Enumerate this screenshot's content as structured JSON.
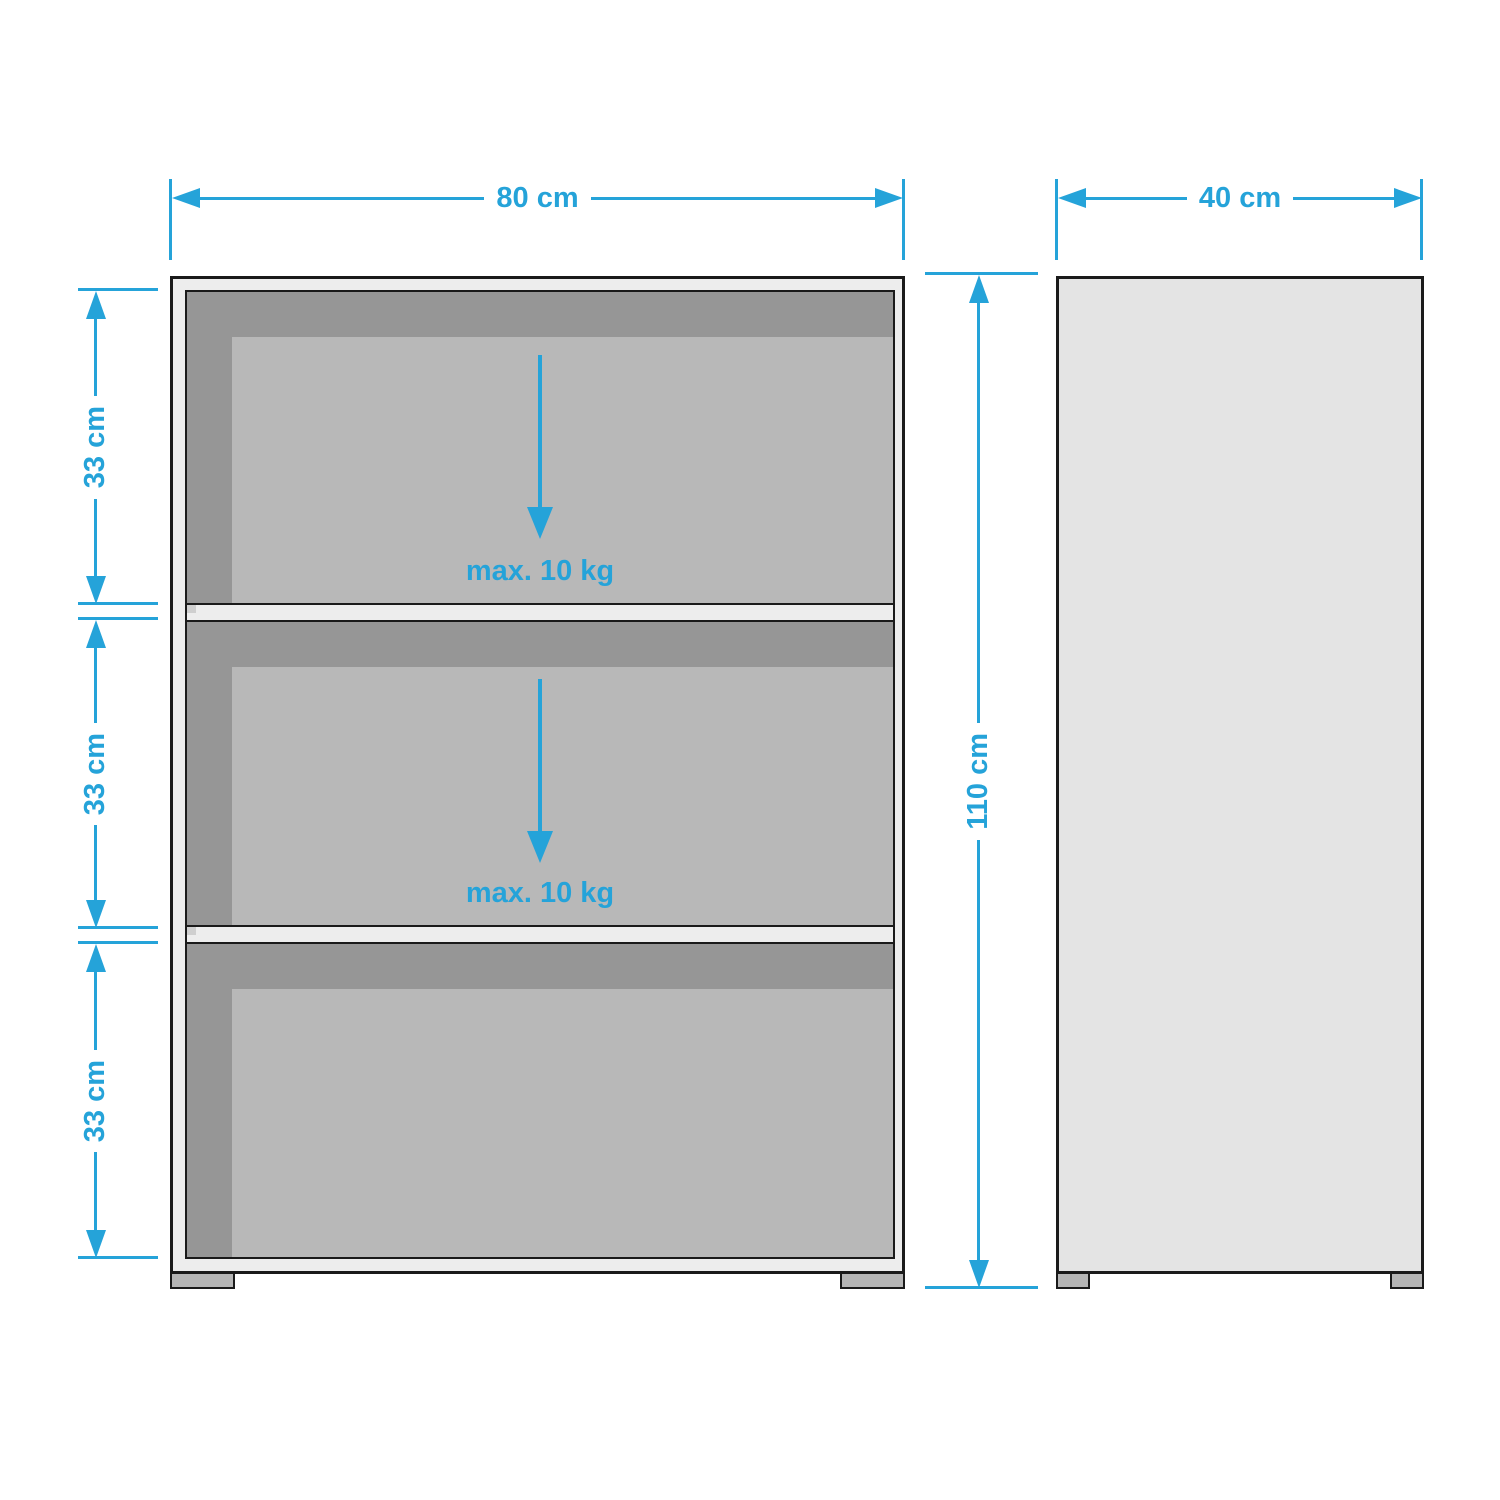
{
  "diagram": {
    "kind": "furniture-dimension-diagram",
    "views": {
      "front": "front-view",
      "side": "side-view"
    },
    "shelf_count": 3
  },
  "dimensions": {
    "width_label": "80 cm",
    "depth_label": "40 cm",
    "height_label": "110 cm",
    "compartment_height_labels": [
      "33 cm",
      "33 cm",
      "33 cm"
    ],
    "shelf_load_labels": [
      "max. 10 kg",
      "max. 10 kg"
    ]
  },
  "colors": {
    "accent_blue": "#25a3d9",
    "outline_dark": "#1a1a1a",
    "panel_light": "#ededed",
    "interior_dark": "#969696",
    "interior_panel": "#b8b8b8",
    "side_panel_fill": "#e4e4e4",
    "foot_fill": "#b5b5b5",
    "background": "#ffffff"
  }
}
